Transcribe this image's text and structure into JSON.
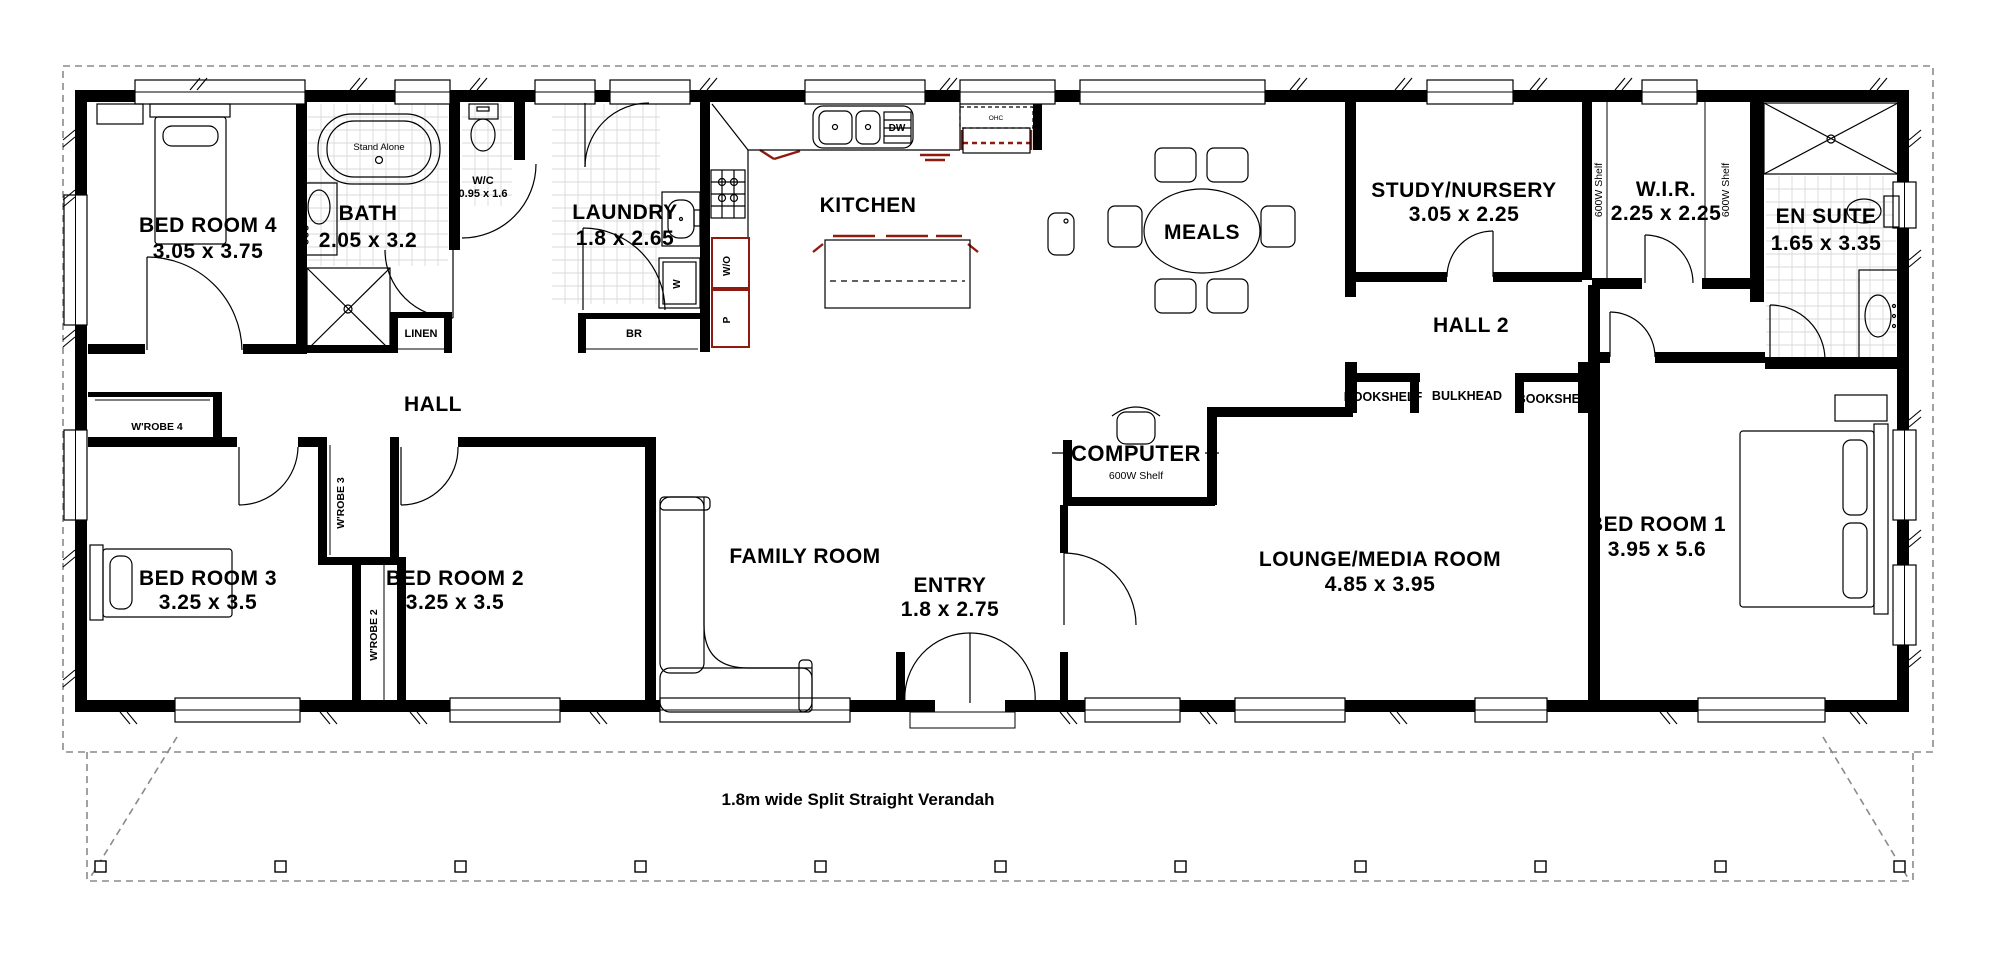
{
  "plan": {
    "rooms": {
      "bed4": {
        "name": "BED ROOM 4",
        "dims": "3.05 x 3.75"
      },
      "bath": {
        "name": "BATH",
        "dims": "2.05 x 3.2"
      },
      "wc": {
        "name": "W/C",
        "dims": "0.95 x 1.6"
      },
      "laundry": {
        "name": "LAUNDRY",
        "dims": "1.8 x 2.65"
      },
      "kitchen": {
        "name": "KITCHEN"
      },
      "meals": {
        "name": "MEALS"
      },
      "study": {
        "name": "STUDY/NURSERY",
        "dims": "3.05 x 2.25"
      },
      "wir": {
        "name": "W.I.R.",
        "dims": "2.25 x 2.25"
      },
      "ensuite": {
        "name": "EN SUITE",
        "dims": "1.65 x 3.35"
      },
      "hall": {
        "name": "HALL"
      },
      "hall2": {
        "name": "HALL 2"
      },
      "bed3": {
        "name": "BED ROOM 3",
        "dims": "3.25 x 3.5"
      },
      "bed2": {
        "name": "BED ROOM 2",
        "dims": "3.25 x 3.5"
      },
      "family": {
        "name": "FAMILY ROOM"
      },
      "computer": {
        "name": "COMPUTER",
        "shelf": "600W Shelf"
      },
      "entry": {
        "name": "ENTRY",
        "dims": "1.8 x 2.75"
      },
      "lounge": {
        "name": "LOUNGE/MEDIA ROOM",
        "dims": "4.85 x 3.95"
      },
      "bed1": {
        "name": "BED ROOM 1",
        "dims": "3.95 x 5.6"
      }
    },
    "closets": {
      "wrobe4": "W'ROBE 4",
      "wrobe3": "W'ROBE 3",
      "wrobe2": "W'ROBE 2",
      "linen": "LINEN",
      "br": "BR",
      "bookshelf_left": "BOOKSHELF",
      "bulkhead": "BULKHEAD",
      "bookshelf_right": "BOOKSHELF",
      "wir_shelf_left": "600W Shelf",
      "wir_shelf_right": "600W Shelf"
    },
    "fixtures": {
      "bath_tub": "Stand Alone",
      "dishwasher": "DW",
      "overhead_cupboard": "OHC",
      "wall_oven": "W/O",
      "pantry": "P",
      "washer": "W"
    },
    "verandah": {
      "label": "1.8m wide Split Straight Verandah"
    },
    "colors": {
      "wall": "#000000",
      "accent": "#8e1b12",
      "tile": "#d9d9d9",
      "dash": "#8a8a8a"
    }
  }
}
